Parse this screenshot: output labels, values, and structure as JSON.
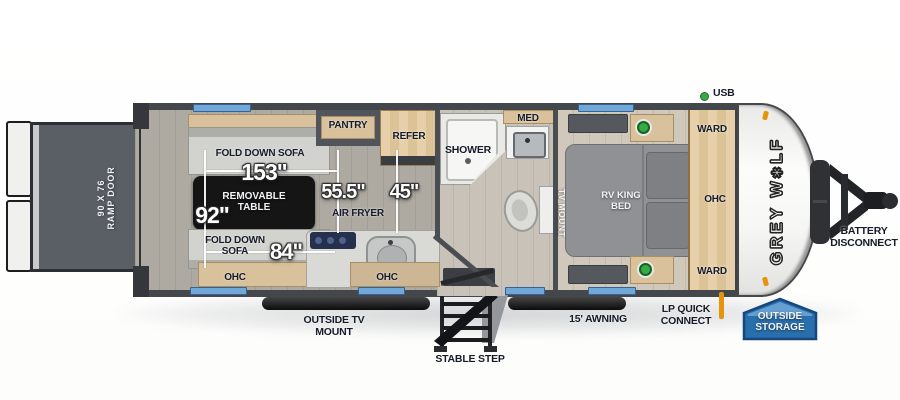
{
  "labels": {
    "ramp1": "90 X 76",
    "ramp2": "RAMP DOOR",
    "sofaTop": "FOLD DOWN SOFA",
    "dim153": "153\"",
    "table": "REMOVABLE TABLE",
    "dim92": "92\"",
    "sofaBottom": "FOLD DOWN SOFA",
    "dim84": "84\"",
    "ohcGarage": "OHC",
    "dim555": "55.5\"",
    "dim45": "45\"",
    "airFryer": "AIR FRYER",
    "pantry": "PANTRY",
    "refer": "REFER",
    "ohcKitchen": "OHC",
    "shower": "SHOWER",
    "med": "MED",
    "tvMount": "TV MOUNT",
    "bed": "RV KING BED",
    "wardTop": "WARD",
    "ohcBed": "OHC",
    "wardBottom": "WARD",
    "usb": "USB",
    "brand1": "GREY W",
    "paw": "✱",
    "brand2": "LF",
    "battery": "BATTERY DISCONNECT",
    "lp": "LP QUICK CONNECT",
    "storage": "OUTSIDE STORAGE",
    "awning": "15' AWNING",
    "outsideTv": "OUTSIDE TV MOUNT",
    "step": "STABLE STEP"
  },
  "colors": {
    "wall": "#44474c",
    "window": "#70a8da",
    "badgeBlue": "#2a6fad",
    "green": "#3aa845",
    "orange": "#e8930c",
    "tableBlack": "#151515"
  }
}
